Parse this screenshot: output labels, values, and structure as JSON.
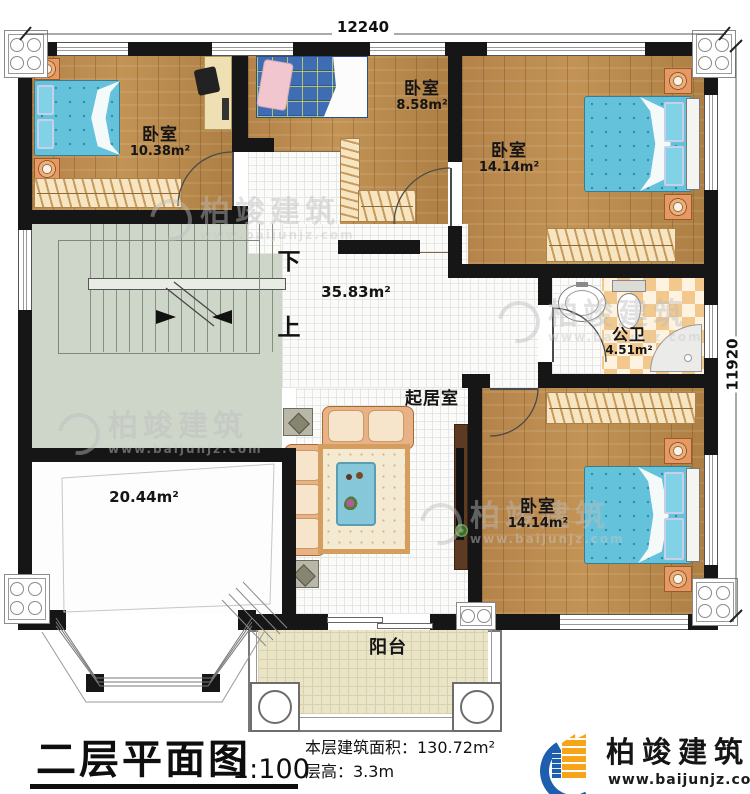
{
  "colors": {
    "wall": "#161616",
    "wood_floor": "#b8884c",
    "tile_floor": "#fbfbfa",
    "stair_floor": "#ced6ca",
    "bathroom_tile": "#f2c88c",
    "balcony_floor": "#ebe5c8",
    "bed_blue": "#64c3da",
    "plaid_bed_blue": "#3e6db4",
    "sofa_tan": "#e9b286",
    "nightstand_orange": "#e59a63",
    "brand_blue": "#1d5fae",
    "brand_orange": "#f7a418"
  },
  "plan": {
    "dimensions": {
      "top": "12240",
      "right": "11920"
    },
    "rooms": {
      "bedroom_top_left": {
        "name": "卧室",
        "area": "10.38m²"
      },
      "bedroom_top_middle": {
        "name": "卧室",
        "area": "8.58m²"
      },
      "bedroom_top_right": {
        "name": "卧室",
        "area": "14.14m²"
      },
      "bedroom_bottom_right": {
        "name": "卧室",
        "area": "14.14m²"
      },
      "bathroom": {
        "name": "公卫",
        "area": "4.51m²"
      },
      "living_room": {
        "name": "起居室"
      },
      "hall": {
        "area": "35.83m²"
      },
      "spare_room": {
        "area": "20.44m²"
      },
      "balcony": {
        "name": "阳台"
      },
      "stairs": {
        "down": "下",
        "up": "上"
      }
    }
  },
  "footer": {
    "title": "二层平面图",
    "scale": "1:100",
    "area_line": "本层建筑面积：130.72m²",
    "height_line": "层高：3.3m",
    "brand_name": "柏竣建筑",
    "brand_site": "www.baijunjz.com"
  },
  "watermark": {
    "name": "柏竣建筑",
    "site": "www.baijunjz.com"
  }
}
